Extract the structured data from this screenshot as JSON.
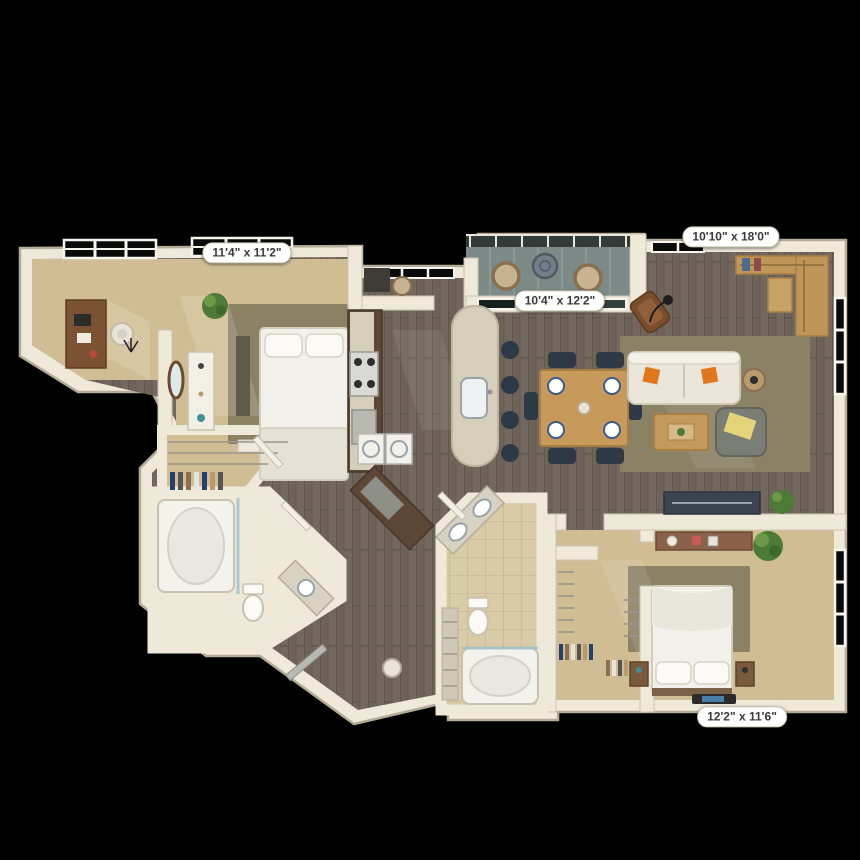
{
  "floor_plan": {
    "background_color": "#000000",
    "dimension_labels": [
      {
        "id": "top-left",
        "text": "11'4\" x 11'2\""
      },
      {
        "id": "top-right",
        "text": "10'10\" x 18'0\""
      },
      {
        "id": "center",
        "text": "10'4\" x 12'2\""
      },
      {
        "id": "bottom-right",
        "text": "12'2\" x 11'6\""
      }
    ],
    "palette": {
      "wall": "#efe9da",
      "wall_edge": "#b5ac97",
      "carpet": "#d0bd93",
      "rug": "#8b8266",
      "wood": "#6f6359",
      "tile": "#d9cba6",
      "glass": "#7d8b88",
      "accent_orange": "#e0771c",
      "navy": "#2e3947",
      "cabinet_brown": "#5c4736",
      "counter": "#d5cebb",
      "plant": "#4d7a36",
      "label_bg": "#ffffff",
      "label_text": "#3a3a3a",
      "label_border": "#c8c2b2"
    }
  }
}
